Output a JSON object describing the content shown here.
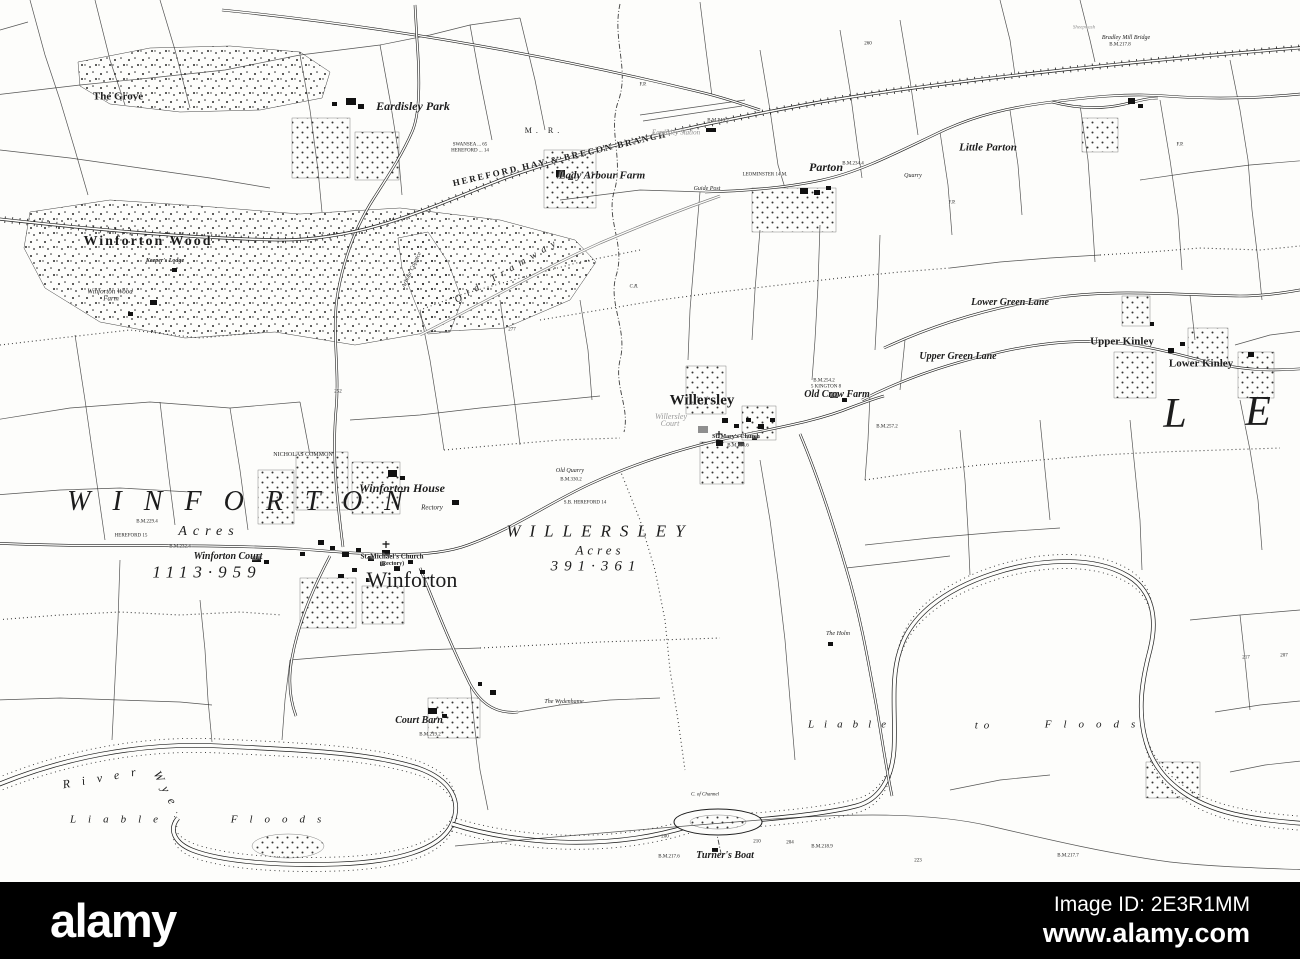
{
  "watermark": {
    "brand": "alamy",
    "image_id": "Image ID: 2E3R1MM",
    "url": "www.alamy.com"
  },
  "map": {
    "labels": [
      {
        "id": "the-grove",
        "text": "The Grove",
        "x": 118,
        "y": 97,
        "size": 11,
        "bold": true
      },
      {
        "id": "eardisley-park",
        "text": "Eardisley Park",
        "x": 413,
        "y": 106,
        "size": 12,
        "italic": true,
        "bold": true
      },
      {
        "id": "swansea-miles",
        "text": "SWANSEA ... 65",
        "x": 470,
        "y": 145,
        "size": 5
      },
      {
        "id": "hereford-miles",
        "text": "HEREFORD ... 14",
        "x": 470,
        "y": 151,
        "size": 5
      },
      {
        "id": "midland-railway",
        "text": "M. R.",
        "x": 544,
        "y": 131,
        "size": 8,
        "ls": 4
      },
      {
        "id": "railway-name",
        "text": "HEREFORD HAY & BRECON BRANCH",
        "x": 560,
        "y": 159,
        "size": 9,
        "bold": true,
        "ls": 2,
        "rotate": -13
      },
      {
        "id": "eardisley-station",
        "text": "Eardisley Station",
        "x": 676,
        "y": 133,
        "size": 7,
        "italic": true,
        "color": "#8e8e8e"
      },
      {
        "id": "bm-2402",
        "text": "B.M.240.2",
        "x": 718,
        "y": 121,
        "size": 5
      },
      {
        "id": "lady-arbour-farm",
        "text": "Lady Arbour Farm",
        "x": 602,
        "y": 176,
        "size": 11,
        "italic": true,
        "bold": true
      },
      {
        "id": "guide-post",
        "text": "Guide Post",
        "x": 707,
        "y": 189,
        "size": 6,
        "italic": true
      },
      {
        "id": "leominster-miles",
        "text": "LEOMINSTER 14 M.",
        "x": 765,
        "y": 175,
        "size": 5
      },
      {
        "id": "parton",
        "text": "Parton",
        "x": 826,
        "y": 167,
        "size": 12,
        "italic": true,
        "bold": true
      },
      {
        "id": "bm-2344",
        "text": "B.M.234.4",
        "x": 853,
        "y": 164,
        "size": 5
      },
      {
        "id": "quarry",
        "text": "Quarry",
        "x": 913,
        "y": 176,
        "size": 6,
        "italic": true
      },
      {
        "id": "little-parton",
        "text": "Little Parton",
        "x": 988,
        "y": 148,
        "size": 11,
        "italic": true,
        "bold": true
      },
      {
        "id": "sheepwash",
        "text": "Sheepwash",
        "x": 1084,
        "y": 28,
        "size": 5,
        "italic": true,
        "color": "#909090"
      },
      {
        "id": "bradley-mill-bridge",
        "text": "Bradley Mill Bridge",
        "x": 1126,
        "y": 38,
        "size": 6,
        "italic": true
      },
      {
        "id": "bm-2178",
        "text": "B.M.217.8",
        "x": 1120,
        "y": 45,
        "size": 5
      },
      {
        "id": "fp-1",
        "text": "F.P.",
        "x": 643,
        "y": 85,
        "size": 5
      },
      {
        "id": "fp-2",
        "text": "F.P.",
        "x": 952,
        "y": 203,
        "size": 5
      },
      {
        "id": "fp-3",
        "text": "F.P.",
        "x": 1180,
        "y": 145,
        "size": 5
      },
      {
        "id": "spot-260",
        "text": "260",
        "x": 868,
        "y": 44,
        "size": 5
      },
      {
        "id": "winforton-wood",
        "text": "Winforton Wood",
        "x": 148,
        "y": 242,
        "size": 14,
        "bold": true,
        "ls": 2
      },
      {
        "id": "keepers-lodge",
        "text": "Keeper's Lodge",
        "x": 165,
        "y": 261,
        "size": 6,
        "italic": true,
        "bold": true
      },
      {
        "id": "winforton-wood-farm",
        "text": "Winforton Wood",
        "x": 110,
        "y": 292,
        "size": 7,
        "italic": true
      },
      {
        "id": "winforton-wood-farm-2",
        "text": "Farm",
        "x": 111,
        "y": 299,
        "size": 7,
        "italic": true
      },
      {
        "id": "old-tramway",
        "text": "Old Tramway",
        "x": 508,
        "y": 271,
        "size": 10,
        "italic": true,
        "ls": 6,
        "rotate": -30
      },
      {
        "id": "arbour-coppice",
        "text": "Arbour Coppice",
        "x": 412,
        "y": 270,
        "size": 6,
        "italic": true,
        "rotate": -65
      },
      {
        "id": "cr-mark",
        "text": "C.R.",
        "x": 634,
        "y": 287,
        "size": 5,
        "italic": true
      },
      {
        "id": "spot-277",
        "text": "277",
        "x": 512,
        "y": 330,
        "size": 5
      },
      {
        "id": "spot-252",
        "text": "252",
        "x": 338,
        "y": 392,
        "size": 5
      },
      {
        "id": "lower-green-lane",
        "text": "Lower Green Lane",
        "x": 1010,
        "y": 303,
        "size": 10,
        "italic": true,
        "bold": true
      },
      {
        "id": "upper-green-lane",
        "text": "Upper Green Lane",
        "x": 958,
        "y": 357,
        "size": 10,
        "italic": true,
        "bold": true
      },
      {
        "id": "upper-kinley",
        "text": "Upper Kinley",
        "x": 1122,
        "y": 342,
        "size": 11,
        "bold": true
      },
      {
        "id": "lower-kinley",
        "text": "Lower Kinley",
        "x": 1201,
        "y": 364,
        "size": 11,
        "bold": true
      },
      {
        "id": "parish-letter-l",
        "text": "L",
        "x": 1175,
        "y": 414,
        "size": 42,
        "italic": true
      },
      {
        "id": "parish-letter-e",
        "text": "E",
        "x": 1258,
        "y": 412,
        "size": 42,
        "italic": true
      },
      {
        "id": "nicholas-common",
        "text": "NICHOLAS COMMON",
        "x": 303,
        "y": 455,
        "size": 6
      },
      {
        "id": "winforton-house",
        "text": "Winforton House",
        "x": 402,
        "y": 488,
        "size": 12,
        "italic": true,
        "bold": true
      },
      {
        "id": "rectory",
        "text": "Rectory",
        "x": 432,
        "y": 508,
        "size": 7,
        "italic": true
      },
      {
        "id": "willersley-village",
        "text": "Willersley",
        "x": 702,
        "y": 401,
        "size": 15,
        "bold": true
      },
      {
        "id": "willersley-court",
        "text": "Willersley",
        "x": 671,
        "y": 417,
        "size": 8,
        "italic": true,
        "color": "#9a9a9a"
      },
      {
        "id": "willersley-court-2",
        "text": "Court",
        "x": 670,
        "y": 424,
        "size": 8,
        "italic": true,
        "color": "#9a9a9a"
      },
      {
        "id": "st-marys-church",
        "text": "St. Mary's Church",
        "x": 736,
        "y": 437,
        "size": 6,
        "bold": true
      },
      {
        "id": "bm-2536",
        "text": "B.M.253.6",
        "x": 738,
        "y": 446,
        "size": 5
      },
      {
        "id": "bm-2542",
        "text": "B.M.254.2",
        "x": 824,
        "y": 381,
        "size": 5
      },
      {
        "id": "kington-miles",
        "text": "5 KINGTON 8",
        "x": 826,
        "y": 387,
        "size": 5
      },
      {
        "id": "old-crow-farm",
        "text": "Old Crow Farm",
        "x": 837,
        "y": 395,
        "size": 10,
        "italic": true,
        "bold": true
      },
      {
        "id": "bm-2572",
        "text": "B.M.257.2",
        "x": 887,
        "y": 427,
        "size": 5
      },
      {
        "id": "old-quarry",
        "text": "Old Quarry",
        "x": 570,
        "y": 471,
        "size": 6,
        "italic": true
      },
      {
        "id": "bm-3302",
        "text": "B.M.330.2",
        "x": 571,
        "y": 480,
        "size": 5
      },
      {
        "id": "sb-hereford-14",
        "text": "S.B. HEREFORD 14",
        "x": 585,
        "y": 503,
        "size": 5
      },
      {
        "id": "winforton-parish",
        "text": "WINFORTON",
        "x": 246,
        "y": 502,
        "size": 28,
        "italic": true,
        "ls": 22
      },
      {
        "id": "winforton-acres-label",
        "text": "Acres",
        "x": 209,
        "y": 532,
        "size": 14,
        "italic": true,
        "ls": 6
      },
      {
        "id": "winforton-acreage",
        "text": "1113·959",
        "x": 207,
        "y": 572,
        "size": 17,
        "italic": true,
        "ls": 6
      },
      {
        "id": "bm-2294",
        "text": "B.M.229.4",
        "x": 147,
        "y": 522,
        "size": 5
      },
      {
        "id": "hereford-15",
        "text": "HEREFORD 15",
        "x": 131,
        "y": 536,
        "size": 5
      },
      {
        "id": "bm-2324",
        "text": "B.M.232.4",
        "x": 180,
        "y": 547,
        "size": 5
      },
      {
        "id": "winforton-court",
        "text": "Winforton Court",
        "x": 228,
        "y": 557,
        "size": 10,
        "italic": true,
        "bold": true
      },
      {
        "id": "st-michaels-church",
        "text": "St. Michael's Church",
        "x": 392,
        "y": 557,
        "size": 7,
        "bold": true
      },
      {
        "id": "st-michaels-rectory",
        "text": "(Rectory)",
        "x": 392,
        "y": 564,
        "size": 6,
        "bold": true
      },
      {
        "id": "winforton-village",
        "text": "Winforton",
        "x": 412,
        "y": 580,
        "size": 22
      },
      {
        "id": "willersley-parish",
        "text": "WILLERSLEY",
        "x": 600,
        "y": 531,
        "size": 17,
        "italic": true,
        "ls": 9
      },
      {
        "id": "willersley-acres-label",
        "text": "Acres",
        "x": 600,
        "y": 550,
        "size": 13,
        "italic": true,
        "ls": 4
      },
      {
        "id": "willersley-acreage",
        "text": "391·361",
        "x": 596,
        "y": 567,
        "size": 15,
        "italic": true,
        "ls": 6
      },
      {
        "id": "the-holm",
        "text": "The Holm",
        "x": 838,
        "y": 634,
        "size": 6,
        "italic": true
      },
      {
        "id": "court-barn",
        "text": "Court Barn",
        "x": 419,
        "y": 721,
        "size": 10,
        "italic": true,
        "bold": true
      },
      {
        "id": "bm-2192",
        "text": "B.M.219.2",
        "x": 430,
        "y": 735,
        "size": 5
      },
      {
        "id": "the-wydenhame",
        "text": "The Wydenhame",
        "x": 564,
        "y": 702,
        "size": 6,
        "italic": true
      },
      {
        "id": "river-label",
        "text": "River",
        "x": 105,
        "y": 777,
        "size": 12,
        "italic": true,
        "ls": 12,
        "rotate": -10
      },
      {
        "id": "wye-label",
        "text": "Wye",
        "x": 167,
        "y": 791,
        "size": 12,
        "italic": true,
        "ls": 8,
        "rotate": 62
      },
      {
        "id": "liable-left",
        "text": "Liable",
        "x": 120,
        "y": 820,
        "size": 11,
        "italic": true,
        "ls": 12
      },
      {
        "id": "floods-left",
        "text": "Floods",
        "x": 282,
        "y": 820,
        "size": 11,
        "italic": true,
        "ls": 12
      },
      {
        "id": "liable-right",
        "text": "Liable",
        "x": 852,
        "y": 725,
        "size": 11,
        "italic": true,
        "ls": 10
      },
      {
        "id": "to-right",
        "text": "to",
        "x": 985,
        "y": 726,
        "size": 11,
        "italic": true,
        "ls": 6
      },
      {
        "id": "floods-right",
        "text": "Floods",
        "x": 1096,
        "y": 725,
        "size": 11,
        "italic": true,
        "ls": 12
      },
      {
        "id": "channel-label",
        "text": "C. of Channel",
        "x": 705,
        "y": 795,
        "size": 5,
        "italic": true
      },
      {
        "id": "spot-200",
        "text": "200",
        "x": 665,
        "y": 837,
        "size": 5
      },
      {
        "id": "spot-210",
        "text": "210",
        "x": 757,
        "y": 842,
        "size": 5
      },
      {
        "id": "spot-204",
        "text": "204",
        "x": 790,
        "y": 843,
        "size": 5
      },
      {
        "id": "turners-boat",
        "text": "Turner's Boat",
        "x": 725,
        "y": 856,
        "size": 10,
        "italic": true,
        "bold": true
      },
      {
        "id": "bm-2176",
        "text": "B.M.217.6",
        "x": 669,
        "y": 857,
        "size": 5
      },
      {
        "id": "bm-2189",
        "text": "B.M.218.9",
        "x": 822,
        "y": 847,
        "size": 5
      },
      {
        "id": "spot-223",
        "text": "223",
        "x": 918,
        "y": 861,
        "size": 5
      },
      {
        "id": "bm-2177",
        "text": "B.M.217.7",
        "x": 1068,
        "y": 856,
        "size": 5
      },
      {
        "id": "spot-217",
        "text": "217",
        "x": 1246,
        "y": 658,
        "size": 5
      },
      {
        "id": "spot-207",
        "text": "207",
        "x": 1284,
        "y": 656,
        "size": 5
      }
    ]
  }
}
